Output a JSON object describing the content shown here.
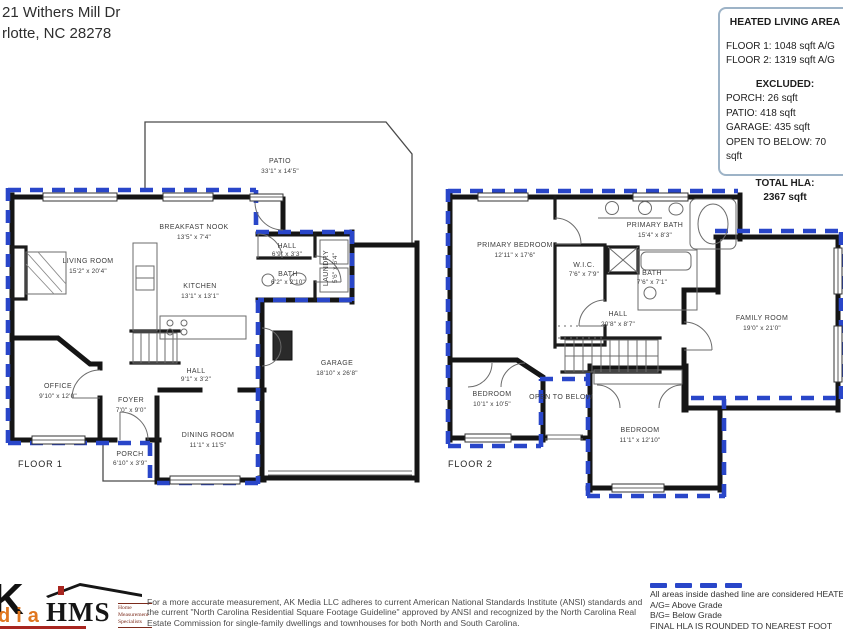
{
  "address": {
    "line1": "21 Withers Mill Dr",
    "line2": "rlotte, NC  28278"
  },
  "hla_box": {
    "title": "HEATED LIVING AREA",
    "floor1": "FLOOR 1: 1048 sqft  A/G",
    "floor2": "FLOOR 2: 1319 sqft  A/G",
    "excluded_title": "EXCLUDED:",
    "excluded": [
      "PORCH: 26 sqft",
      "PATIO: 418 sqft",
      "GARAGE: 435 sqft",
      "OPEN TO BELOW: 70 sqft"
    ],
    "total_title": "TOTAL HLA:",
    "total_value": "2367 sqft"
  },
  "floor1": {
    "label": "FLOOR 1",
    "rooms": [
      {
        "name": "PATIO",
        "dims": "33'1\" x 14'5\""
      },
      {
        "name": "BREAKFAST NOOK",
        "dims": "13'5\" x 7'4\""
      },
      {
        "name": "LIVING ROOM",
        "dims": "15'2\" x 20'4\""
      },
      {
        "name": "KITCHEN",
        "dims": "13'1\" x 13'1\""
      },
      {
        "name": "HALL",
        "dims": "6'9\" x 3'3\""
      },
      {
        "name": "BATH",
        "dims": "6'2\" x 2'10\""
      },
      {
        "name": "LAUNDRY",
        "dims": "5'6\" x 6'4\""
      },
      {
        "name": "OFFICE",
        "dims": "9'10\" x 12'0\""
      },
      {
        "name": "FOYER",
        "dims": "7'0\" x 9'0\""
      },
      {
        "name": "HALL",
        "dims": "9'1\" x 3'2\""
      },
      {
        "name": "DINING ROOM",
        "dims": "11'1\" x 11'5\""
      },
      {
        "name": "PORCH",
        "dims": "6'10\" x 3'9\""
      },
      {
        "name": "GARAGE",
        "dims": "18'10\" x 26'8\""
      }
    ]
  },
  "floor2": {
    "label": "FLOOR 2",
    "rooms": [
      {
        "name": "PRIMARY BEDROOM",
        "dims": "12'11\" x 17'6\""
      },
      {
        "name": "PRIMARY BATH",
        "dims": "15'4\" x 8'3\""
      },
      {
        "name": "W.I.C.",
        "dims": "7'6\" x 7'9\""
      },
      {
        "name": "BATH",
        "dims": "7'6\" x 7'1\""
      },
      {
        "name": "HALL",
        "dims": "20'8\" x 8'7\""
      },
      {
        "name": "FAMILY ROOM",
        "dims": "19'0\" x 21'0\""
      },
      {
        "name": "BEDROOM",
        "dims": "10'1\" x 10'5\""
      },
      {
        "name": "OPEN TO BELOW",
        "dims": ""
      },
      {
        "name": "BEDROOM",
        "dims": "11'1\" x 12'10\""
      }
    ]
  },
  "legend": {
    "line1": "All areas inside dashed line are considered HEATED LIVING",
    "line2": "A/G= Above Grade",
    "line3": "B/G= Below Grade",
    "line4": "FINAL HLA IS ROUNDED TO NEAREST FOOT"
  },
  "footer": {
    "disclaimer": "For a more accurate measurement, AK Media LLC adheres to current American National Standards Institute (ANSI) standards and the current \"North Carolina Residential Square Footage Guideline\" approved by ANSI and recognized by the North Carolina Real Estate Commission for single-family dwellings and townhouses for both North and South Carolina.",
    "ak_logo_k": "K",
    "ak_logo_dia": "dia",
    "hms_logo": "HMS",
    "hms_sub1": "Home",
    "hms_sub2": "Measurement",
    "hms_sub3": "Specialists"
  },
  "colors": {
    "heated_dashed_line": "#2946c9",
    "wall": "#151515",
    "hla_box_border": "#9db3c7",
    "ak_orange": "#e0761f",
    "logo_red": "#a8251f"
  }
}
